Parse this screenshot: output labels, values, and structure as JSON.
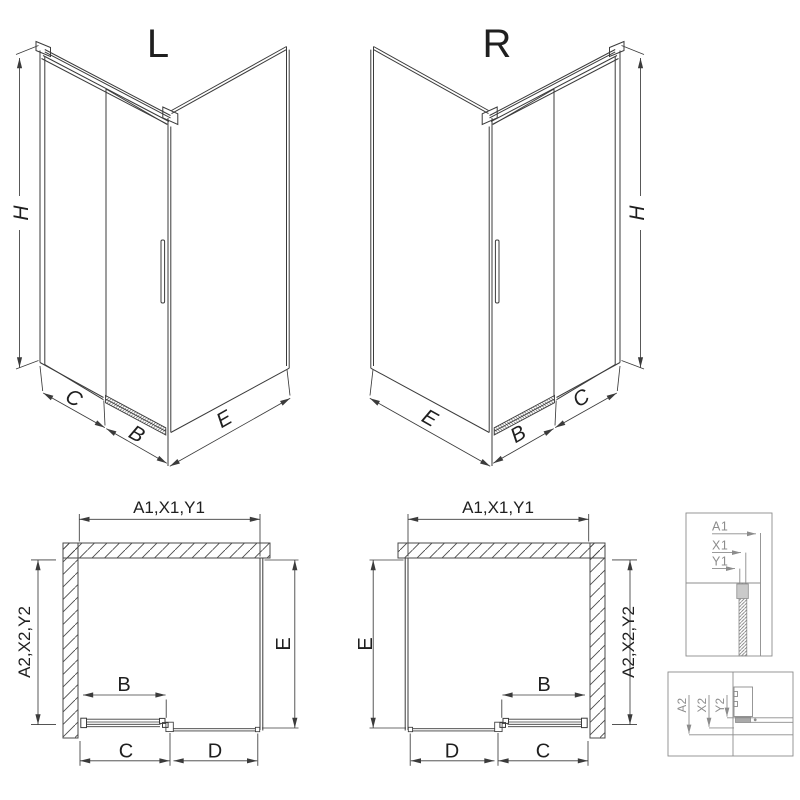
{
  "colors": {
    "line": "#3b3b3b",
    "detail_line": "#8c8c8c",
    "wall_hatch": "#4a4a4a",
    "background": "#ffffff"
  },
  "views": {
    "iso_left": {
      "title": "L",
      "height_label": "H",
      "front_left_labels": [
        "C",
        "B"
      ],
      "front_right_label": "E"
    },
    "iso_right": {
      "title": "R",
      "height_label": "H",
      "front_left_label": "E",
      "front_right_labels": [
        "B",
        "C"
      ]
    },
    "plan_left": {
      "width_label": "A1,X1,Y1",
      "depth_label": "A2,X2,Y2",
      "side_label": "E",
      "door_label": "B",
      "bottom_labels": [
        "C",
        "D"
      ]
    },
    "plan_right": {
      "width_label": "A1,X1,Y1",
      "depth_label": "A2,X2,Y2",
      "side_label": "E",
      "door_label": "B",
      "bottom_labels": [
        "D",
        "C"
      ]
    },
    "detail_width": {
      "labels": [
        "A1",
        "X1",
        "Y1"
      ]
    },
    "detail_depth": {
      "labels": [
        "A2",
        "X2",
        "Y2"
      ]
    }
  }
}
